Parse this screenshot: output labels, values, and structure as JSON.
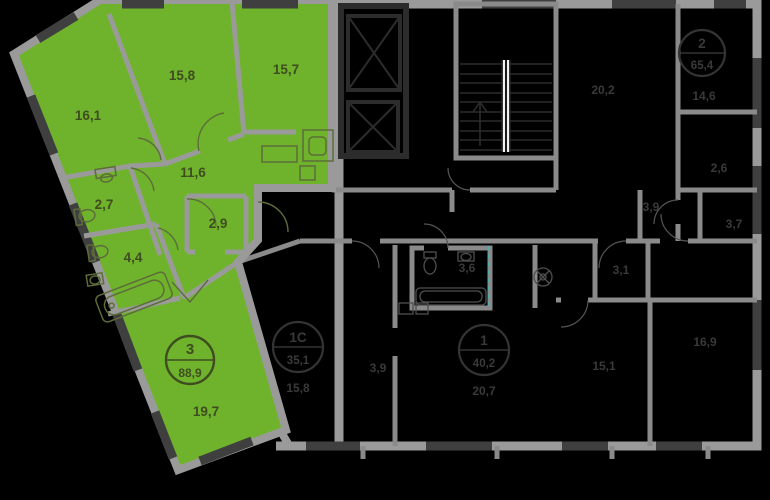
{
  "plan": {
    "type": "floorplan",
    "background": "#000000",
    "colors": {
      "highlight_green": "#6fb32c",
      "outer_walls": "#9a9a9a",
      "window_segments": "#3f3f3f",
      "dark_walls": "#2c2c2c",
      "faint_labels": "#3a3a3a",
      "green_labels": "#3e4c20",
      "section_marker_teal": "#3fb5b5",
      "stair_rail": "#f2f2f2"
    },
    "selected_apartment": {
      "badge": {
        "rooms": "3",
        "area": "88,9"
      },
      "rooms": [
        {
          "id": "bedroom-1",
          "area": "16,1"
        },
        {
          "id": "bedroom-2",
          "area": "15,8"
        },
        {
          "id": "kitchen",
          "area": "15,7"
        },
        {
          "id": "hallway",
          "area": "11,6"
        },
        {
          "id": "wc",
          "area": "2,7"
        },
        {
          "id": "wardrobe",
          "area": "2,9"
        },
        {
          "id": "bathroom",
          "area": "4,4"
        },
        {
          "id": "living-room",
          "area": "19,7"
        }
      ]
    },
    "neighbor_apartments": {
      "badges": [
        {
          "rooms": "2",
          "area": "65,4",
          "room_label": "14,6"
        },
        {
          "rooms": "1С",
          "area": "35,1",
          "room_label": "15,8"
        },
        {
          "rooms": "1",
          "area": "40,2",
          "room_label": "20,7"
        }
      ],
      "room_labels": [
        "20,2",
        "3,9",
        "2,6",
        "3,7",
        "3,1",
        "3,6",
        "3,9",
        "15,1",
        "16,9"
      ]
    }
  }
}
